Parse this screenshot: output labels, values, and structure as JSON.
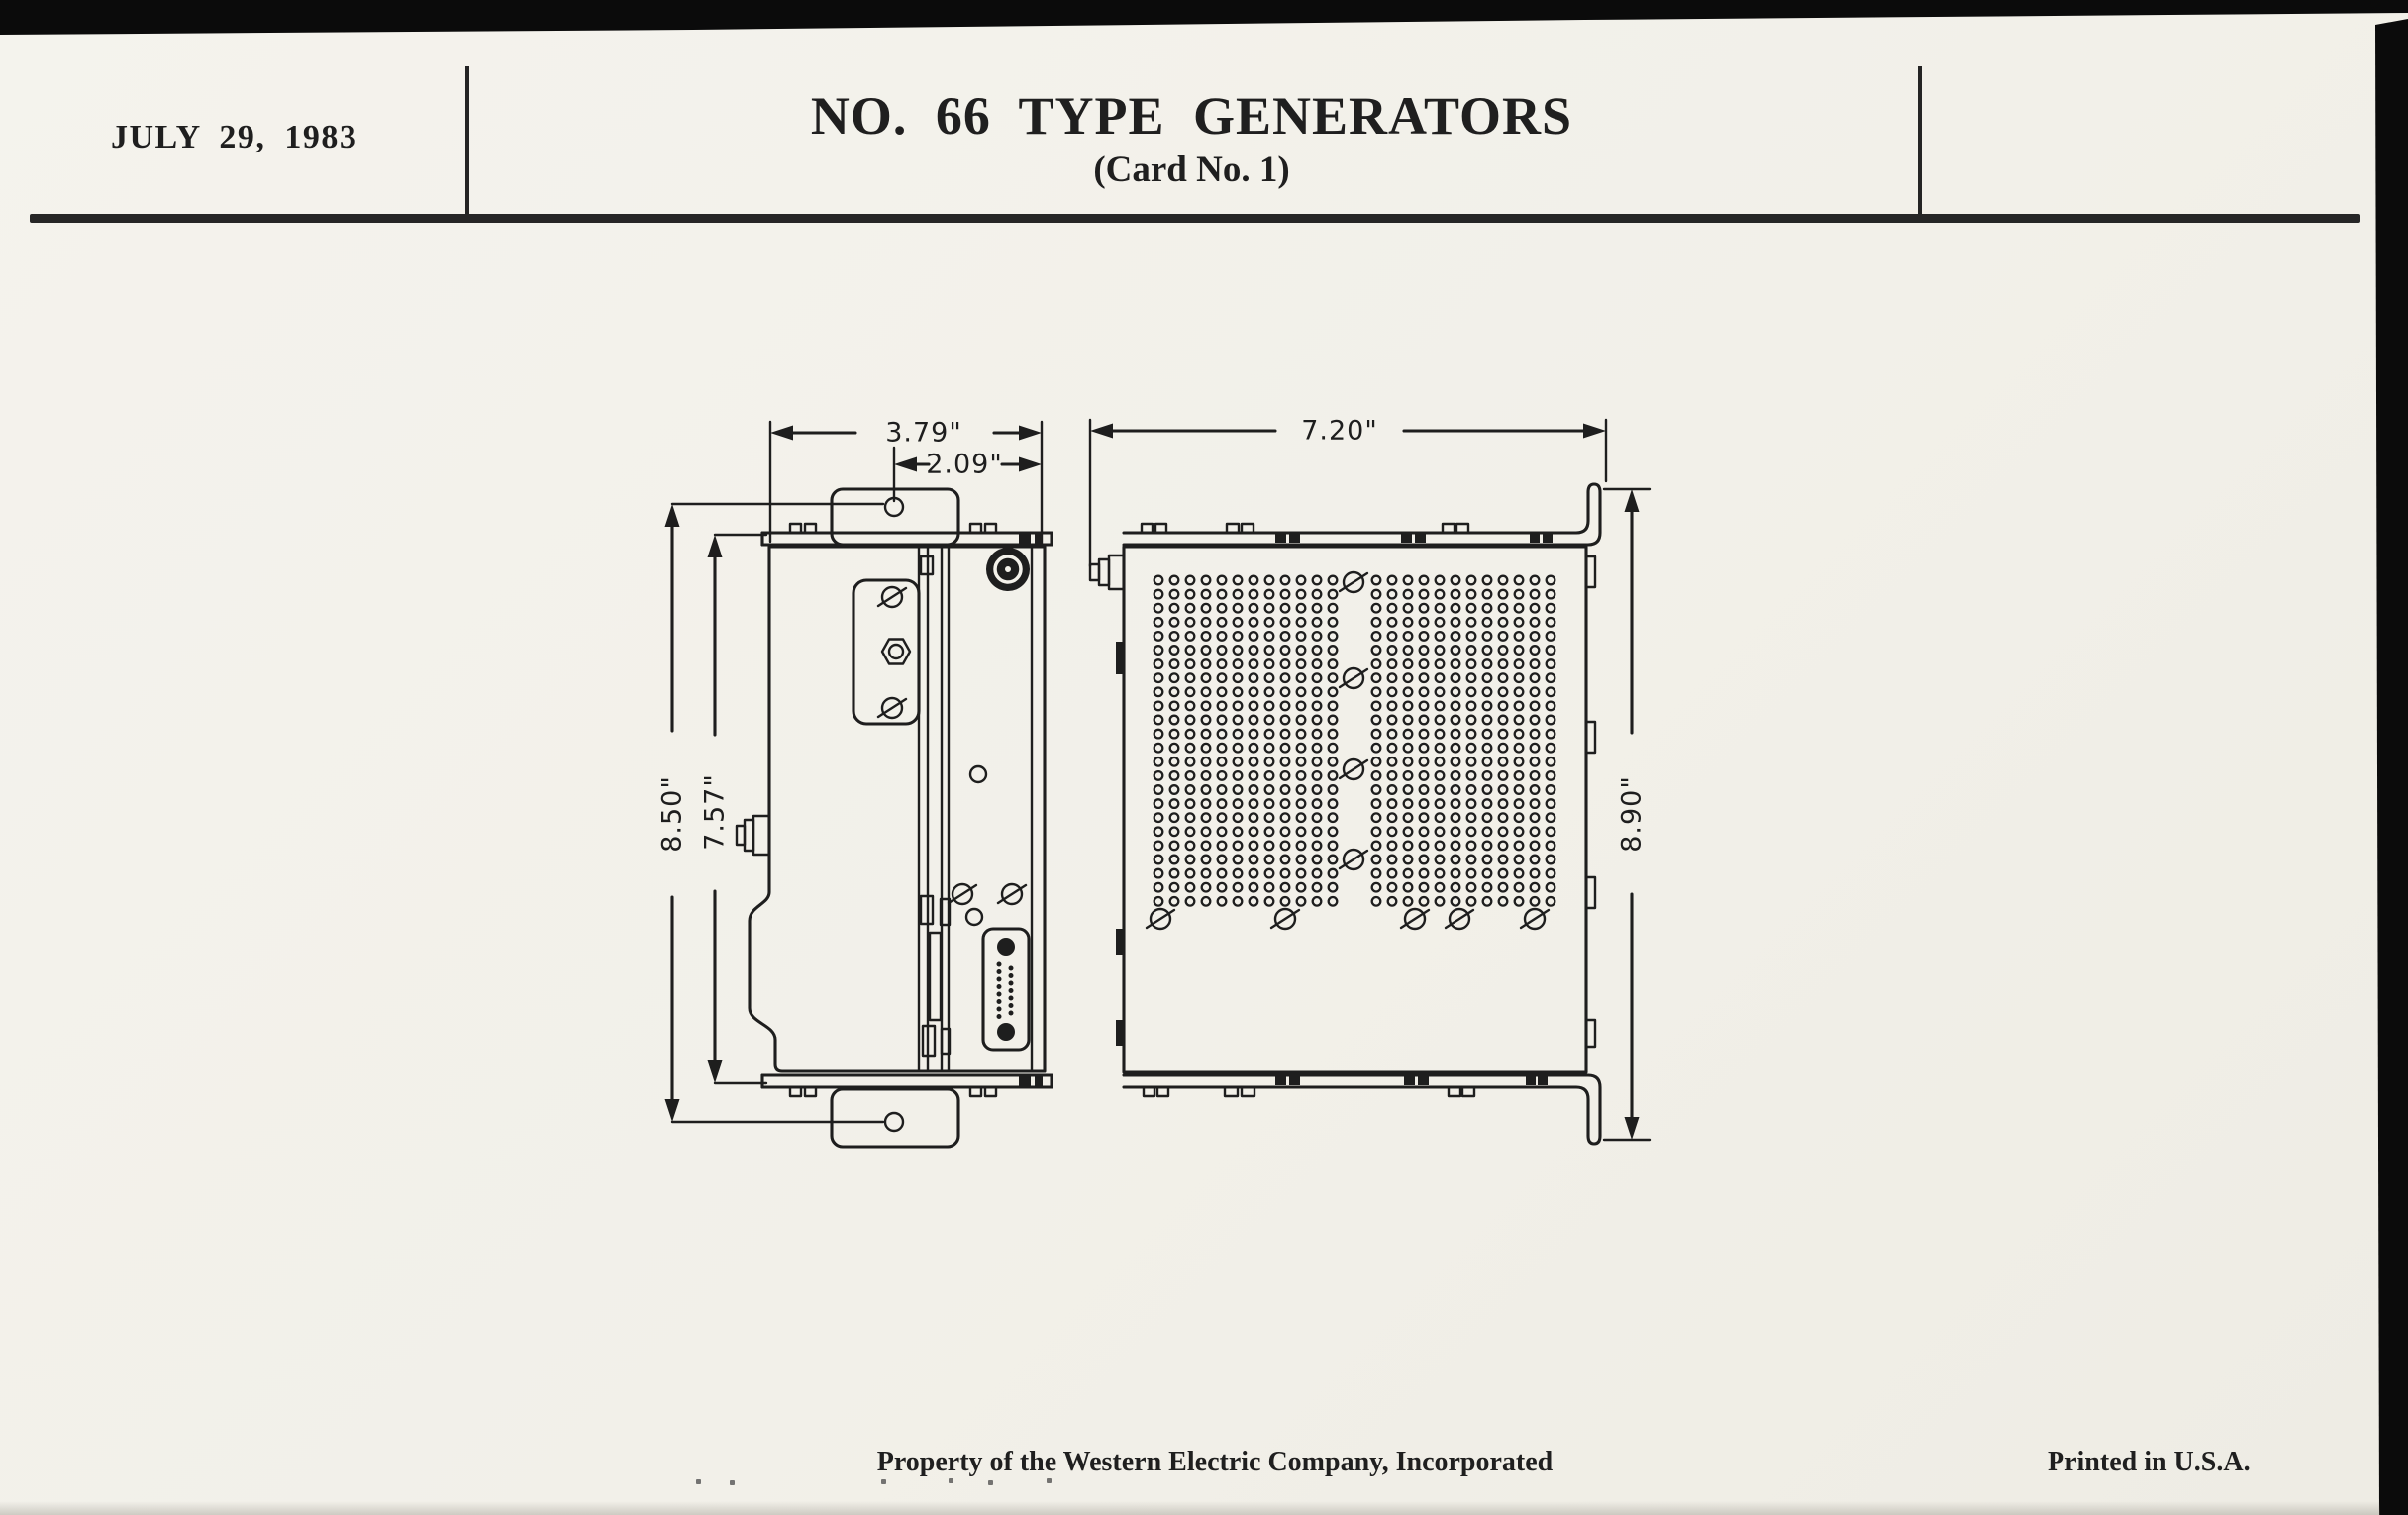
{
  "header": {
    "date": "JULY 29, 1983",
    "title": "NO. 66 TYPE GENERATORS",
    "subtitle": "(Card No. 1)"
  },
  "drawings": {
    "side_view": {
      "dim_depth_overall": "3.79\"",
      "dim_mount_hole_offset": "2.09\"",
      "dim_mount_hole_centers": "8.50\"",
      "dim_body_height": "7.57\""
    },
    "front_view": {
      "dim_width_overall": "7.20\"",
      "dim_bracket_height": "8.90\""
    }
  },
  "footer": {
    "property_notice": "Property of the Western Electric Company, Incorporated",
    "printed_notice": "Printed in U.S.A."
  },
  "colors": {
    "paper": "#f3f1ea",
    "ink": "#1e1e1e"
  }
}
